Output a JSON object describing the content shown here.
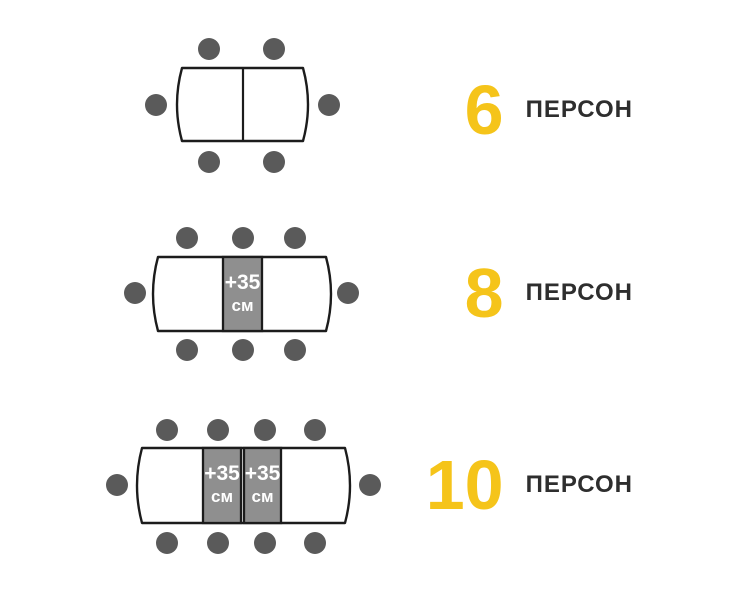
{
  "colors": {
    "accent": "#F5C41A",
    "seat": "#5A5A5A",
    "leaf": "#8F8F8F",
    "outline": "#1C1C1C",
    "text": "#2E2E2E",
    "leaf_text": "#FFFFFF",
    "background": "#FFFFFF"
  },
  "rows": [
    {
      "count": "6",
      "label": "ПЕРСОН",
      "seats": {
        "top": 2,
        "bottom": 2,
        "left": 1,
        "right": 1,
        "total": 6
      },
      "leaves": []
    },
    {
      "count": "8",
      "label": "ПЕРСОН",
      "seats": {
        "top": 3,
        "bottom": 3,
        "left": 1,
        "right": 1,
        "total": 8
      },
      "leaves": [
        {
          "text": "+35",
          "unit": "см"
        }
      ]
    },
    {
      "count": "10",
      "label": "ПЕРСОН",
      "seats": {
        "top": 4,
        "bottom": 4,
        "left": 1,
        "right": 1,
        "total": 10
      },
      "leaves": [
        {
          "text": "+35",
          "unit": "см"
        },
        {
          "text": "+35",
          "unit": "см"
        }
      ]
    }
  ]
}
